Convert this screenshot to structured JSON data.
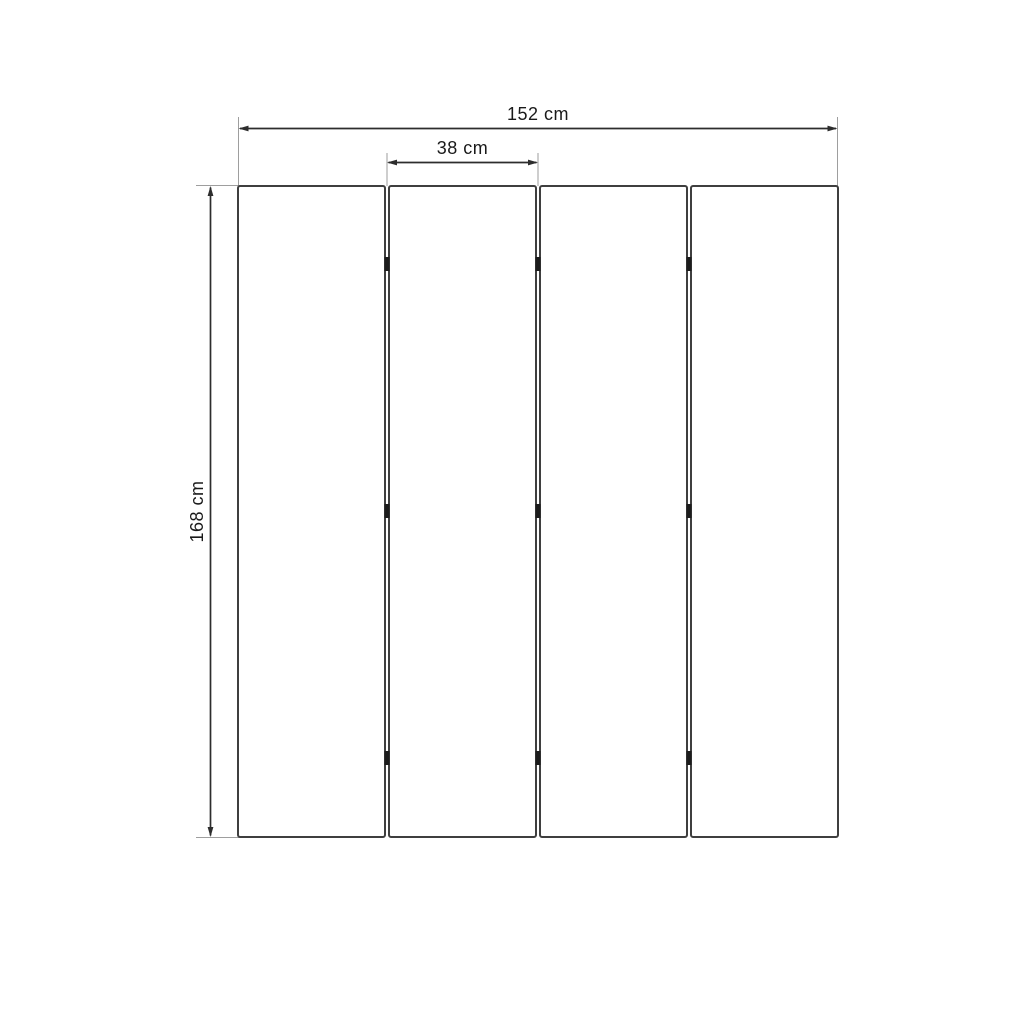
{
  "diagram": {
    "type": "technical-dimension-drawing",
    "subject": "four-panel folding screen, front elevation",
    "structure": {
      "panel_count": 4,
      "joint_count": 3,
      "hinges_per_joint": 3
    },
    "dimensions": {
      "total_width": {
        "label": "152 cm",
        "value": 152,
        "unit": "cm"
      },
      "panel_width": {
        "label": "38 cm",
        "value": 38,
        "unit": "cm"
      },
      "height": {
        "label": "168 cm",
        "value": 168,
        "unit": "cm"
      }
    },
    "colors": {
      "background": "#ffffff",
      "panel_fill": "#ffffff",
      "panel_border": "#3f3f3f",
      "dimension_line": "#2d2d2d",
      "extension_line": "#9e9e9e",
      "hinge": "#1c1c1c",
      "text": "#1a1a1a"
    }
  }
}
